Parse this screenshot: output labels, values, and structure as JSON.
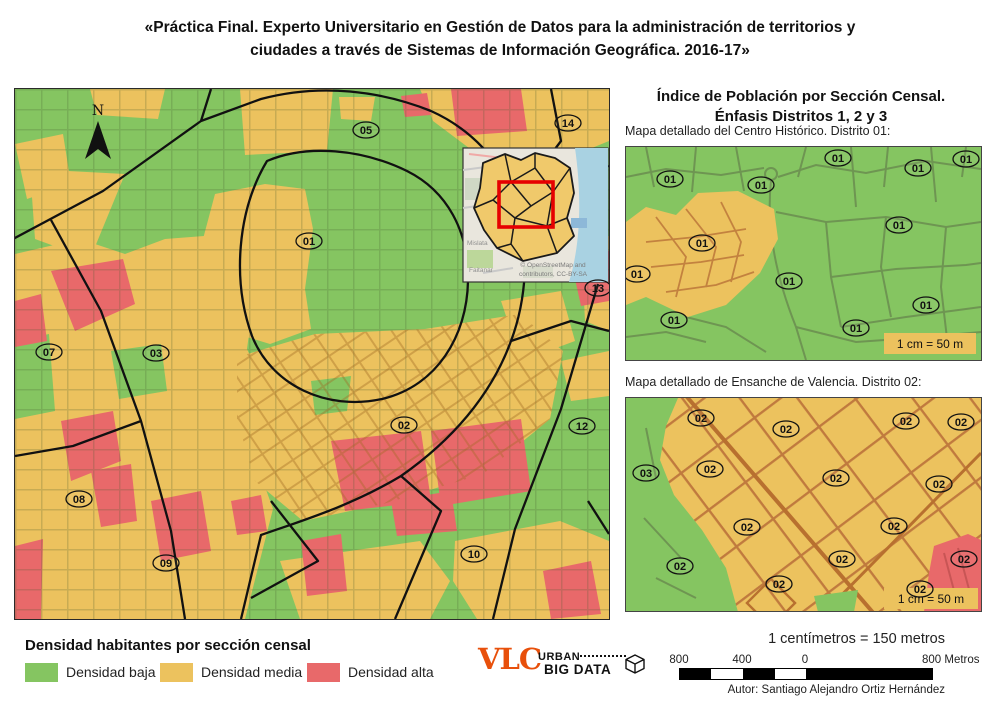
{
  "title_line1": "«Práctica Final. Experto Universitario en Gestión de Datos para la administración de territorios y",
  "title_line2": "ciudades a través de Sistemas de Información Geográfica. 2016-17»",
  "colors": {
    "density_low": "#85c561",
    "density_medium": "#ecc25e",
    "density_high": "#e8696a",
    "logo_accent": "#e8500b",
    "inset_highlight": "#e60000"
  },
  "main_map": {
    "north_label": "N",
    "labels": [
      {
        "t": "05",
        "x": 351,
        "y": 41
      },
      {
        "t": "14",
        "x": 553,
        "y": 34
      },
      {
        "t": "01",
        "x": 294,
        "y": 152
      },
      {
        "t": "13",
        "x": 583,
        "y": 199
      },
      {
        "t": "07",
        "x": 34,
        "y": 263
      },
      {
        "t": "03",
        "x": 141,
        "y": 264
      },
      {
        "t": "02",
        "x": 389,
        "y": 336
      },
      {
        "t": "12",
        "x": 567,
        "y": 337
      },
      {
        "t": "08",
        "x": 64,
        "y": 410
      },
      {
        "t": "09",
        "x": 151,
        "y": 474
      },
      {
        "t": "10",
        "x": 459,
        "y": 465
      }
    ],
    "inset": {
      "attribution_line1": "© OpenStreetMap and",
      "attribution_line2": "contributors, CC-BY-SA",
      "place_labels": [
        "Mislata",
        "Faitanar"
      ]
    }
  },
  "right_panel": {
    "title_line1": "Índice de Población por Sección Censal.",
    "title_line2": "Énfasis Distritos 1, 2 y 3",
    "map_district01": {
      "caption": "Mapa detallado del Centro Histórico. Distrito 01:",
      "scale_note": "1 cm = 50 m",
      "labels": [
        {
          "t": "01",
          "x": 212,
          "y": 11
        },
        {
          "t": "01",
          "x": 340,
          "y": 12
        },
        {
          "t": "01",
          "x": 292,
          "y": 21
        },
        {
          "t": "01",
          "x": 44,
          "y": 32
        },
        {
          "t": "01",
          "x": 135,
          "y": 38
        },
        {
          "t": "01",
          "x": 273,
          "y": 78
        },
        {
          "t": "01",
          "x": 76,
          "y": 96
        },
        {
          "t": "01",
          "x": 11,
          "y": 127
        },
        {
          "t": "01",
          "x": 163,
          "y": 134
        },
        {
          "t": "01",
          "x": 300,
          "y": 158
        },
        {
          "t": "01",
          "x": 48,
          "y": 173
        },
        {
          "t": "01",
          "x": 230,
          "y": 181
        }
      ]
    },
    "map_district02": {
      "caption": "Mapa detallado de Ensanche de Valencia. Distrito 02:",
      "scale_note": "1 cm = 50 m",
      "labels": [
        {
          "t": "02",
          "x": 75,
          "y": 20
        },
        {
          "t": "02",
          "x": 160,
          "y": 31
        },
        {
          "t": "02",
          "x": 280,
          "y": 23
        },
        {
          "t": "02",
          "x": 335,
          "y": 24
        },
        {
          "t": "03",
          "x": 20,
          "y": 75
        },
        {
          "t": "02",
          "x": 84,
          "y": 71
        },
        {
          "t": "02",
          "x": 210,
          "y": 80
        },
        {
          "t": "02",
          "x": 313,
          "y": 86
        },
        {
          "t": "02",
          "x": 121,
          "y": 129
        },
        {
          "t": "02",
          "x": 268,
          "y": 128
        },
        {
          "t": "02",
          "x": 216,
          "y": 161
        },
        {
          "t": "02",
          "x": 338,
          "y": 161
        },
        {
          "t": "02",
          "x": 54,
          "y": 168
        },
        {
          "t": "02",
          "x": 153,
          "y": 186
        },
        {
          "t": "02",
          "x": 294,
          "y": 191
        }
      ]
    }
  },
  "legend": {
    "title": "Densidad habitantes por sección censal",
    "items": [
      {
        "label": "Densidad baja",
        "color": "#85c561"
      },
      {
        "label": "Densidad media",
        "color": "#ecc25e"
      },
      {
        "label": "Densidad alta",
        "color": "#e8696a"
      }
    ]
  },
  "footer": {
    "logo": {
      "vlc": "VLC",
      "line1": "URBAN",
      "line2": "BIG DATA"
    },
    "scale_equation": "1 centímetros = 150 metros",
    "scalebar_ticks": [
      "800",
      "400",
      "0"
    ],
    "scalebar_end_label": "800 Metros",
    "author": "Autor: Santiago Alejandro Ortiz Hernández"
  }
}
